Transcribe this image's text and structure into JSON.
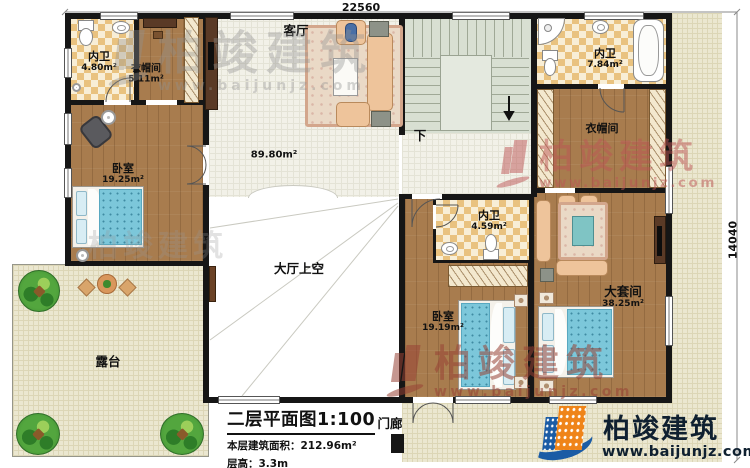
{
  "dims": {
    "top": "22560",
    "right": "14040"
  },
  "rooms": {
    "bath_top_left": {
      "name": "内卫",
      "area": "4.80m²"
    },
    "cloak_left": {
      "name": "衣帽间",
      "area": "5.11m²"
    },
    "bedroom_left": {
      "name": "卧室",
      "area": "19.25m²"
    },
    "living": {
      "name": "客厅",
      "area": "89.80m²"
    },
    "bath_top_right": {
      "name": "内卫",
      "area": "7.84m²"
    },
    "cloak_right": {
      "name": "衣帽间"
    },
    "bath_middle": {
      "name": "内卫",
      "area": "4.59m²"
    },
    "bedroom_bottom": {
      "name": "卧室",
      "area": "19.19m²"
    },
    "suite": {
      "name": "大套间",
      "area": "38.25m²"
    },
    "hall_void": {
      "name": "大厅上空"
    },
    "terrace": {
      "name": "露台"
    },
    "porch": {
      "name": "门廊"
    }
  },
  "stairs": {
    "down": "下"
  },
  "title_block": {
    "title": "二层平面图1:100",
    "area_line": "本层建筑面积：212.96m²",
    "floor_height": "层高：3.3m"
  },
  "watermark": {
    "brand": "柏竣建筑",
    "url": "www.baijunjz.com"
  },
  "logo": {
    "brand": "柏竣建筑",
    "url": "www.baijunjz.com"
  },
  "colors": {
    "accent_blue": "#1b5ca5",
    "accent_orange": "#ef8419",
    "wall": "#161616",
    "bed": "#7cc7da"
  }
}
